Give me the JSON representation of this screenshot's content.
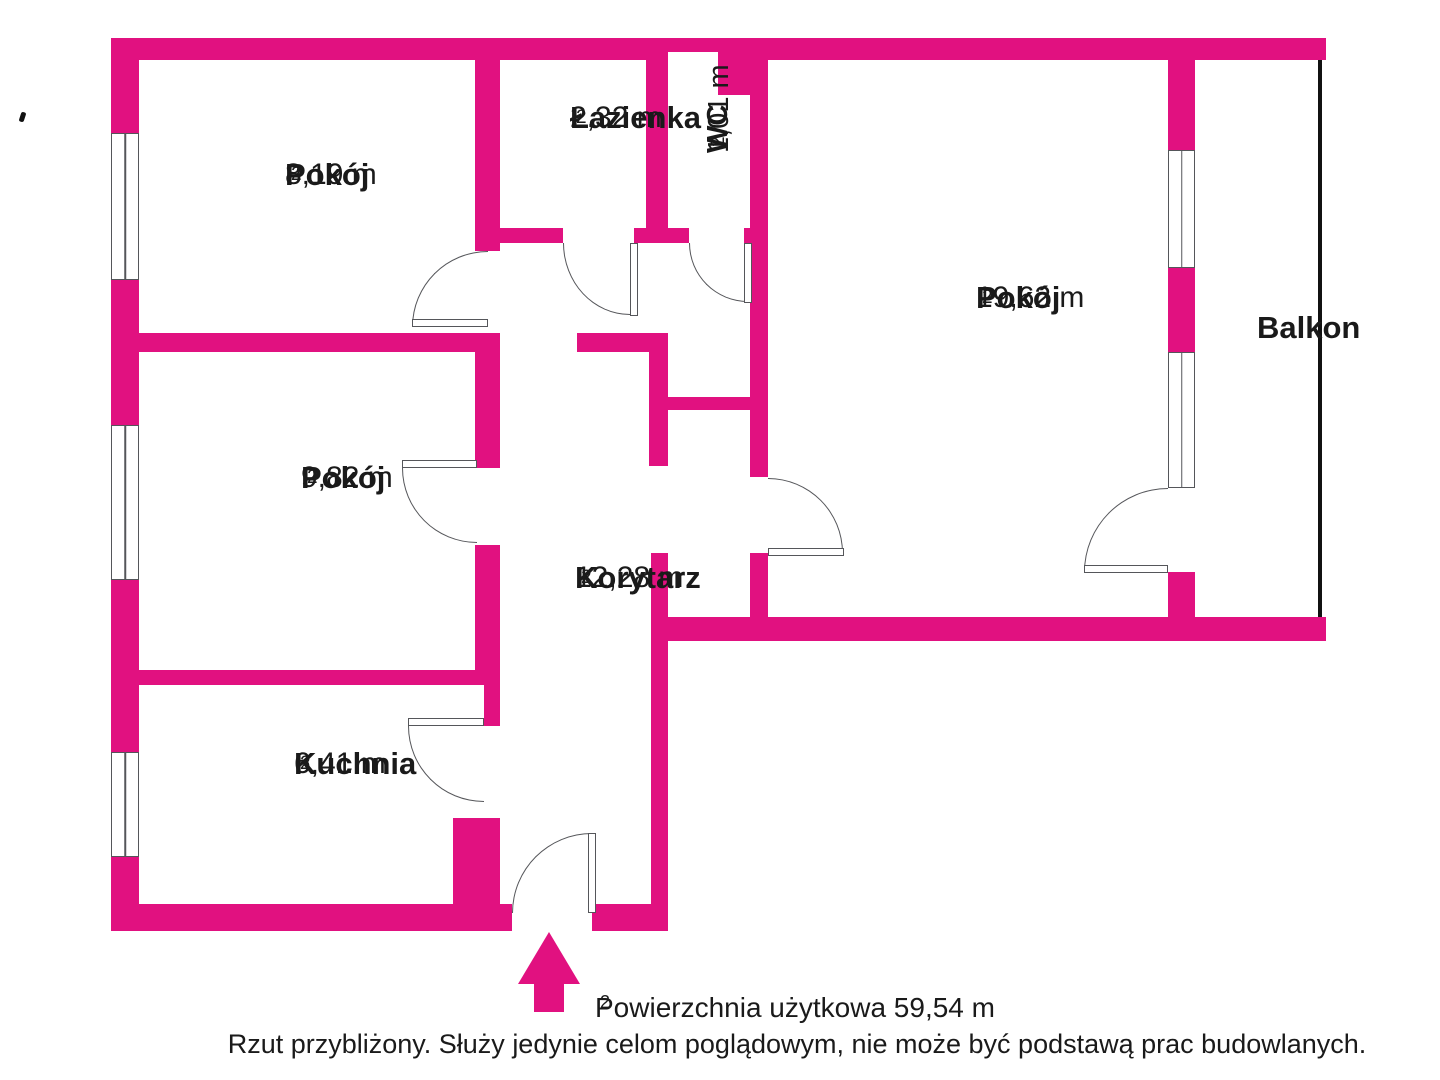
{
  "colors": {
    "wall_pink": "#e11180",
    "line_gray": "#55565a",
    "text": "#1a1a1a"
  },
  "rooms": {
    "room_top_left": {
      "name": "Pokój",
      "area": "8,19 m",
      "sup": "2"
    },
    "bathroom": {
      "name": "Łazienka",
      "area": "2,32 m",
      "sup": "2"
    },
    "wc": {
      "name": "WC",
      "area": "1,01 m",
      "sup": "2"
    },
    "room_large": {
      "name": "Pokój",
      "area": "19,62 m",
      "sup": "2"
    },
    "balcony": {
      "name": "Balkon"
    },
    "room_middle": {
      "name": "Pokój",
      "area": "9,82 m",
      "sup": "2"
    },
    "corridor": {
      "name": "Korytarz",
      "area": "12,28 m",
      "sup": "2"
    },
    "kitchen": {
      "name": "Kuchnia",
      "area": "6,41 m",
      "sup": "2"
    }
  },
  "footer": {
    "total_label": "Powierzchnia użytkowa 59,54 m",
    "total_sup": "2",
    "disclaimer": "Rzut przybliżony. Służy jedynie celom poglądowym, nie może być podstawą prac budowlanych."
  },
  "icons": {
    "entrance_arrow": "up-arrow"
  }
}
